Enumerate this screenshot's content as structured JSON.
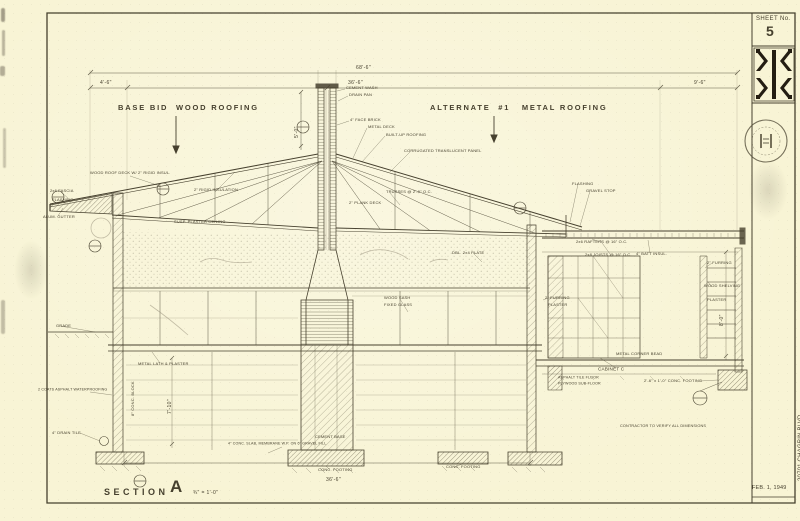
{
  "colors": {
    "paper": "#f8f4d5",
    "ink": "#46402e",
    "pencil": "#978f7a"
  },
  "sidebar": {
    "sheet_label": "SHEET No.",
    "sheet_number": "5",
    "date": "FEB. 1, 1949",
    "title_line_address": "20701 CHAGRIN BLVD.",
    "title_line_architect": "WILLIAM  B.  MORRIS    ARCHITECT          SHAKER  HEIGHTS   OHIO",
    "title_line_location": "S.L.#188  SOUTH  WOODLAND  ROAD        VILLAGE  OF  PEPPER  PIKE",
    "title_line_project": "RESIDENCE  FOR  MR. & MRS.  STANLEY  A.  MEISEL"
  },
  "section": {
    "label": "SECTION",
    "letter": "A",
    "scale": "¾\" = 1'-0\""
  },
  "callouts": {
    "left_roof": "BASE BID  WOOD ROOFING",
    "right_roof": "ALTERNATE  #1   METAL ROOFING"
  },
  "annotations": [
    {
      "t": "68'-6\"",
      "x": 356,
      "y": 65,
      "s": 5,
      "c": "dim"
    },
    {
      "t": "36'-6\"",
      "x": 348,
      "y": 80,
      "s": 5,
      "c": "dim"
    },
    {
      "t": "4'-6\"",
      "x": 100,
      "y": 80,
      "s": 5,
      "c": "dim"
    },
    {
      "t": "9'-6\"",
      "x": 694,
      "y": 80,
      "s": 5,
      "c": "dim"
    },
    {
      "t": "36'-6\"",
      "x": 326,
      "y": 477,
      "s": 5,
      "c": "dim"
    },
    {
      "t": "5'-0\"",
      "x": 294,
      "y": 138,
      "s": 5,
      "r": -90,
      "c": "dim"
    },
    {
      "t": "7'-10\"",
      "x": 167,
      "y": 414,
      "s": 5,
      "r": -90,
      "c": "dim"
    },
    {
      "t": "8'-0\"",
      "x": 719,
      "y": 326,
      "s": 5,
      "r": -90,
      "c": "dim"
    },
    {
      "t": "¾\" = 1'-0\"",
      "x": 193,
      "y": 490,
      "s": 5,
      "c": "dim"
    },
    {
      "t": "CEMENT WASH",
      "x": 346,
      "y": 86
    },
    {
      "t": "DRAIN PAN",
      "x": 349,
      "y": 93
    },
    {
      "t": "4\" FACE BRICK",
      "x": 350,
      "y": 118
    },
    {
      "t": "METAL DECK",
      "x": 368,
      "y": 125
    },
    {
      "t": "BUILT-UP ROOFING",
      "x": 386,
      "y": 133
    },
    {
      "t": "CORRUGATED TRANSLUCENT PANEL",
      "x": 404,
      "y": 149
    },
    {
      "t": "WOOD ROOF DECK W/ 2\" RIGID INSUL.",
      "x": 90,
      "y": 171
    },
    {
      "t": "2\" RIGID INSULATION",
      "x": 194,
      "y": 188
    },
    {
      "t": "2x6 FASCIA",
      "x": 50,
      "y": 189
    },
    {
      "t": "FLASHING",
      "x": 52,
      "y": 198
    },
    {
      "t": "ALUM. GUTTER",
      "x": 43,
      "y": 215
    },
    {
      "t": "SUSP. PLASTER CEILING",
      "x": 174,
      "y": 220
    },
    {
      "t": "TRUSSES @ 2'-0\" O.C.",
      "x": 386,
      "y": 190
    },
    {
      "t": "2\" PLANK DECK",
      "x": 349,
      "y": 201
    },
    {
      "t": "FLASHING",
      "x": 572,
      "y": 182
    },
    {
      "t": "GRAVEL STOP",
      "x": 586,
      "y": 189
    },
    {
      "t": "2x6 RAFTERS @ 16\" O.C.",
      "x": 576,
      "y": 240
    },
    {
      "t": "2x8 JOISTS @ 16\" O.C.",
      "x": 585,
      "y": 253
    },
    {
      "t": "4\" BATT INSUL.",
      "x": 636,
      "y": 252
    },
    {
      "t": "2\" FURRING",
      "x": 707,
      "y": 261
    },
    {
      "t": "WOOD SHELVING",
      "x": 704,
      "y": 284
    },
    {
      "t": "PLASTER",
      "x": 707,
      "y": 298
    },
    {
      "t": "CABINET C",
      "x": 598,
      "y": 367,
      "s": 4.6
    },
    {
      "t": "METAL CORNER BEAD",
      "x": 616,
      "y": 352
    },
    {
      "t": "ASPHALT TILE FLOOR",
      "x": 558,
      "y": 376,
      "s": 3.6
    },
    {
      "t": "PLYWOOD SUB-FLOOR",
      "x": 558,
      "y": 382,
      "s": 3.6
    },
    {
      "t": "2'-6\" x 1'-0\" CONC. FOOTING",
      "x": 644,
      "y": 379
    },
    {
      "t": "CONTRACTOR TO VERIFY ALL DIMENSIONS",
      "x": 620,
      "y": 424,
      "s": 3.8
    },
    {
      "t": "GRADE",
      "x": 56,
      "y": 324
    },
    {
      "t": "2 COATS ASPHALT WATERPROOFING",
      "x": 38,
      "y": 388,
      "s": 3.6
    },
    {
      "t": "4\" DRAIN TILE",
      "x": 52,
      "y": 431
    },
    {
      "t": "8\" CONC. BLOCK",
      "x": 131,
      "y": 416,
      "r": -90
    },
    {
      "t": "METAL LATH & PLASTER",
      "x": 138,
      "y": 362
    },
    {
      "t": "4\" CONC. SLAB, MEMBRANE W.P. ON 6\" GRAVEL FILL",
      "x": 228,
      "y": 442,
      "s": 3.6
    },
    {
      "t": "CEMENT BASE",
      "x": 315,
      "y": 435
    },
    {
      "t": "CONC. FOOTING",
      "x": 318,
      "y": 468
    },
    {
      "t": "CONC. FOOTING",
      "x": 446,
      "y": 465
    },
    {
      "t": "WOOD SASH",
      "x": 384,
      "y": 296
    },
    {
      "t": "FIXED GLASS",
      "x": 384,
      "y": 303
    },
    {
      "t": "DBL. 2x4 PLATE",
      "x": 452,
      "y": 251
    },
    {
      "t": "2\" FURRING",
      "x": 545,
      "y": 296
    },
    {
      "t": "PLASTER",
      "x": 548,
      "y": 303
    }
  ]
}
